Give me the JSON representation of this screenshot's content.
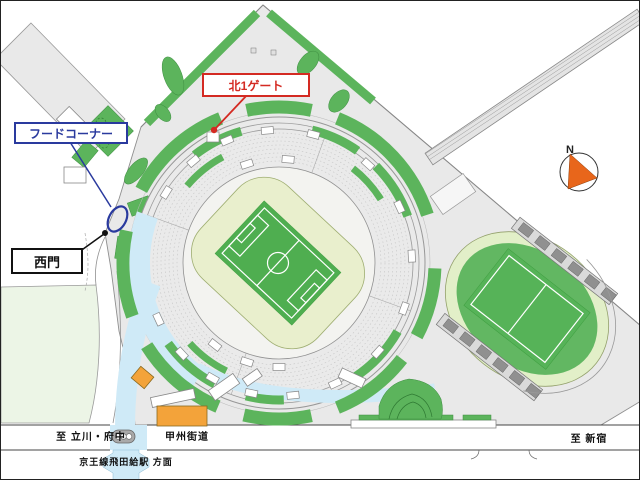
{
  "annotations": {
    "north_gate": {
      "label": "北1ゲート"
    },
    "food_corner": {
      "label": "フードコーナー"
    },
    "west_gate": {
      "label": "西門"
    }
  },
  "road_labels": {
    "to_tachikawa_fuchu": "至 立川・府中",
    "koshu_kaido": "甲州街道",
    "to_shinjuku": "至 新宿",
    "to_tobitakyu_station": "京王線飛田給駅 方面"
  },
  "compass": {
    "north": "N"
  },
  "icons": {
    "compass": "north-arrow-icon",
    "crosswalk": "crosswalk-icon",
    "food_corner_marker": "ellipse-marker-icon",
    "north_gate_marker": "red-dot-marker-icon",
    "west_gate_marker": "black-dot-marker-icon"
  },
  "colors": {
    "green": "#5cb45c",
    "pale_field": "#e9efcd",
    "pitch": "#4fae50",
    "walkway": "#cfeaf7",
    "orange": "#f3a33a",
    "red": "#d42a22",
    "blue": "#2a3a9e",
    "gray": "#e9e9e9",
    "pale_park": "#ecf5e6",
    "compass": "#e8661b"
  }
}
